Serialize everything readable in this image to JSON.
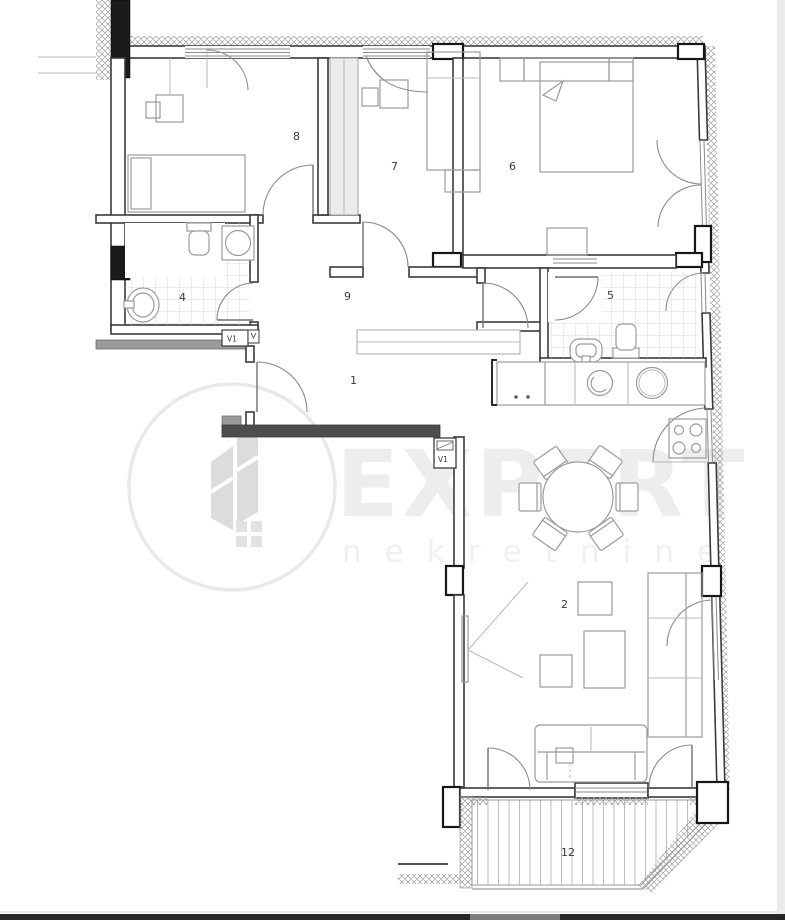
{
  "page": {
    "background_color": "#ffffff",
    "right_margin_color": "#ececec",
    "scrollbar": {
      "track_color": "#262626",
      "thumb_color": "#7d7d7d"
    }
  },
  "watermark": {
    "brand": "EXPERT",
    "brand_sub": "nekretnine",
    "color": "#ededed"
  },
  "floorplan": {
    "type": "apartment-floor-plan",
    "wall_color": "#3a3a3a",
    "room_labels": [
      {
        "id": "entry-hall",
        "label": "1"
      },
      {
        "id": "living-room",
        "label": "2"
      },
      {
        "id": "bathroom-left",
        "label": "4"
      },
      {
        "id": "bathroom-right",
        "label": "5"
      },
      {
        "id": "bedroom-right",
        "label": "6"
      },
      {
        "id": "bedroom-middle",
        "label": "7"
      },
      {
        "id": "bedroom-left",
        "label": "8"
      },
      {
        "id": "hallway",
        "label": "9"
      },
      {
        "id": "terrace",
        "label": "12"
      }
    ],
    "shaft_labels": [
      {
        "id": "vent-shaft-1",
        "label": "V1"
      },
      {
        "id": "vent-shaft-2",
        "label": "V1"
      }
    ]
  }
}
